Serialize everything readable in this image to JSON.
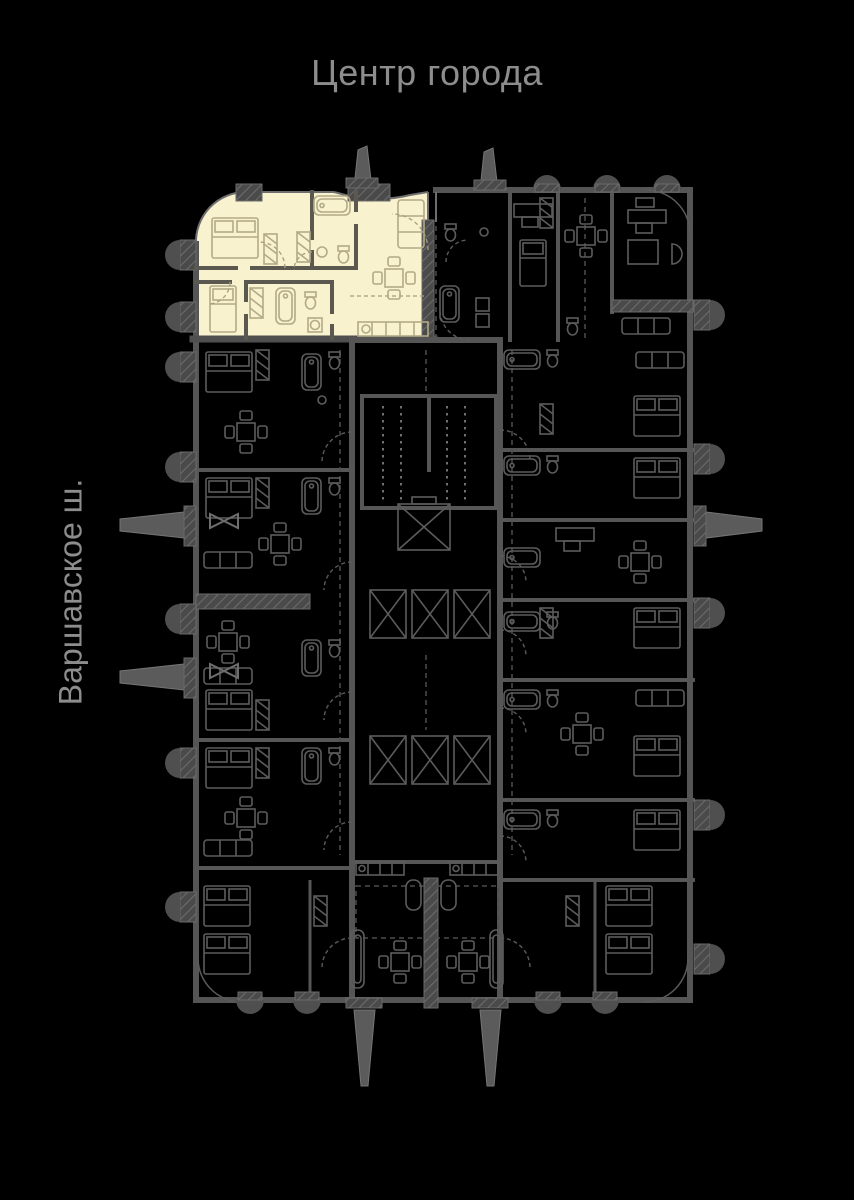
{
  "labels": {
    "top_direction": "Центр города",
    "left_street": "Варшавское ш."
  },
  "colors": {
    "background": "#000000",
    "label_text": "#8d8d8d",
    "plan_line": "#5e5e5e",
    "plan_wall": "#545454",
    "plan_dim": "#454545",
    "highlight_fill": "#f9f2cf",
    "highlight_line": "#b3aa87",
    "highlight_wall": "#5b5850"
  }
}
